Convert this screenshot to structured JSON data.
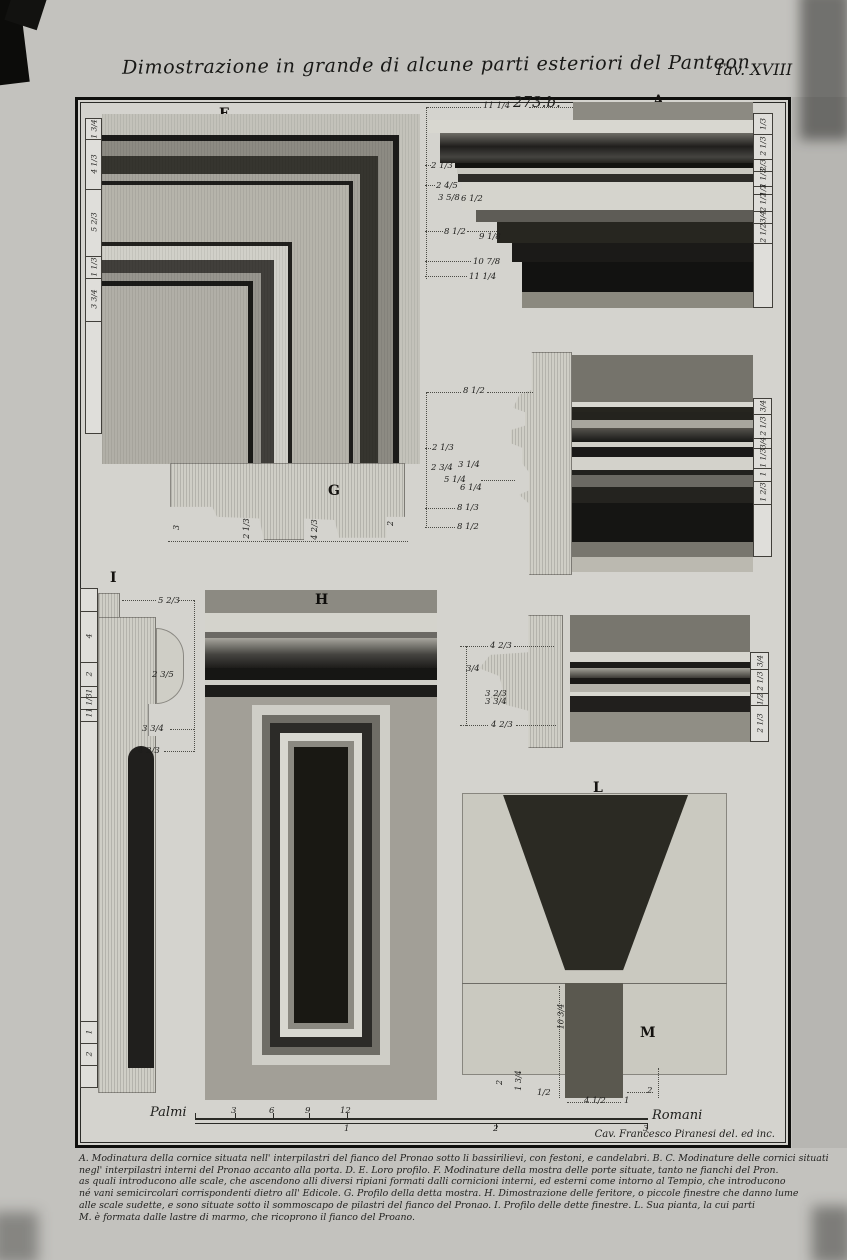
{
  "title": {
    "text": "Dimostrazione in grande di alcune parti esteriori del Panteon",
    "plate_no": "Tav. XVIII"
  },
  "ref_no": "273.b.",
  "credit": "Cav. Francesco Piranesi del. ed inc.",
  "labels": {
    "F": "F",
    "A": "A",
    "B": "B",
    "C": "C",
    "D": "D",
    "E": "E",
    "G": "G",
    "H": "H",
    "I": "I",
    "L": "L",
    "M": "M"
  },
  "scale_bar": {
    "left": "Palmi",
    "right": "Romani",
    "top_ticks": [
      "3",
      "6",
      "9",
      "12"
    ],
    "bottom_ticks": [
      "1",
      "2",
      "3"
    ]
  },
  "caption": {
    "lines": [
      "A. Modinatura della cornice situata nell' interpilastri del fianco del Pronao sotto li bassirilievi, con festoni, e candelabri. B. C. Modinature delle cornici situati",
      "negl' interpilastri interni del Pronao accanto alla porta. D. E. Loro profilo. F. Modinature della mostra delle porte situate, tanto ne fianchi del Pron.",
      "as quali introducono alle scale, che ascendono alli diversi ripiani formati dalli cornicioni interni, ed esterni come intorno al Tempio, che introducono",
      "né vani semicircolari corrispondenti dietro all' Edicole. G. Profilo della detta mostra. H. Dimostrazione delle feritore, o piccole finestre che danno lume",
      "alle scale sudette, e sono situate sotto il sommoscapo de pilastri del fianco del Pronao. I. Profilo delle dette finestre. L. Sua pianta, la cui parti",
      "M. è formata dalle lastre di marmo, che ricoprono il fianco del Proano."
    ]
  },
  "m": {
    "f": [
      "1 3/4",
      "4 1/3",
      "5 2/3",
      "1 1/3",
      "3 3/4"
    ],
    "a_l": [
      "11 1/4",
      "2 1/3",
      "2 4/5",
      "3 5/8",
      "6 1/2",
      "8 1/2",
      "9 1/8",
      "10 7/8",
      "11 1/4"
    ],
    "a_r": [
      "1/3",
      "2 1/3",
      "2/3",
      "1 1/3",
      "1/2",
      "2 1/2",
      "3/4",
      "2 1/2"
    ],
    "d": [
      "8 1/2",
      "2 1/3",
      "2 3/4",
      "3 1/4",
      "5 1/4",
      "6 1/4",
      "8 1/3",
      "8 1/2"
    ],
    "b_r": [
      "3/4",
      "2 1/3",
      "3/4",
      "1 1/3",
      "1",
      "1 2/3"
    ],
    "e": [
      "4 2/3",
      "3/4",
      "3 2/3",
      "3 3/4",
      "4 2/3"
    ],
    "c_r": [
      "3/4",
      "2 1/3",
      "1/2",
      "2 1/3"
    ],
    "g": [
      "3",
      "2 1/3",
      "4 2/3",
      "2"
    ],
    "i_col": [
      "4",
      "2",
      "1",
      "1 1/3",
      "1",
      "1",
      "2"
    ],
    "i": [
      "5 2/3",
      "2 3/5",
      "3 3/4",
      "4 2/3"
    ],
    "lm": [
      "10 3/4",
      "2",
      "1 3/4",
      "1/2",
      "4 1/2",
      "1",
      "2"
    ]
  }
}
